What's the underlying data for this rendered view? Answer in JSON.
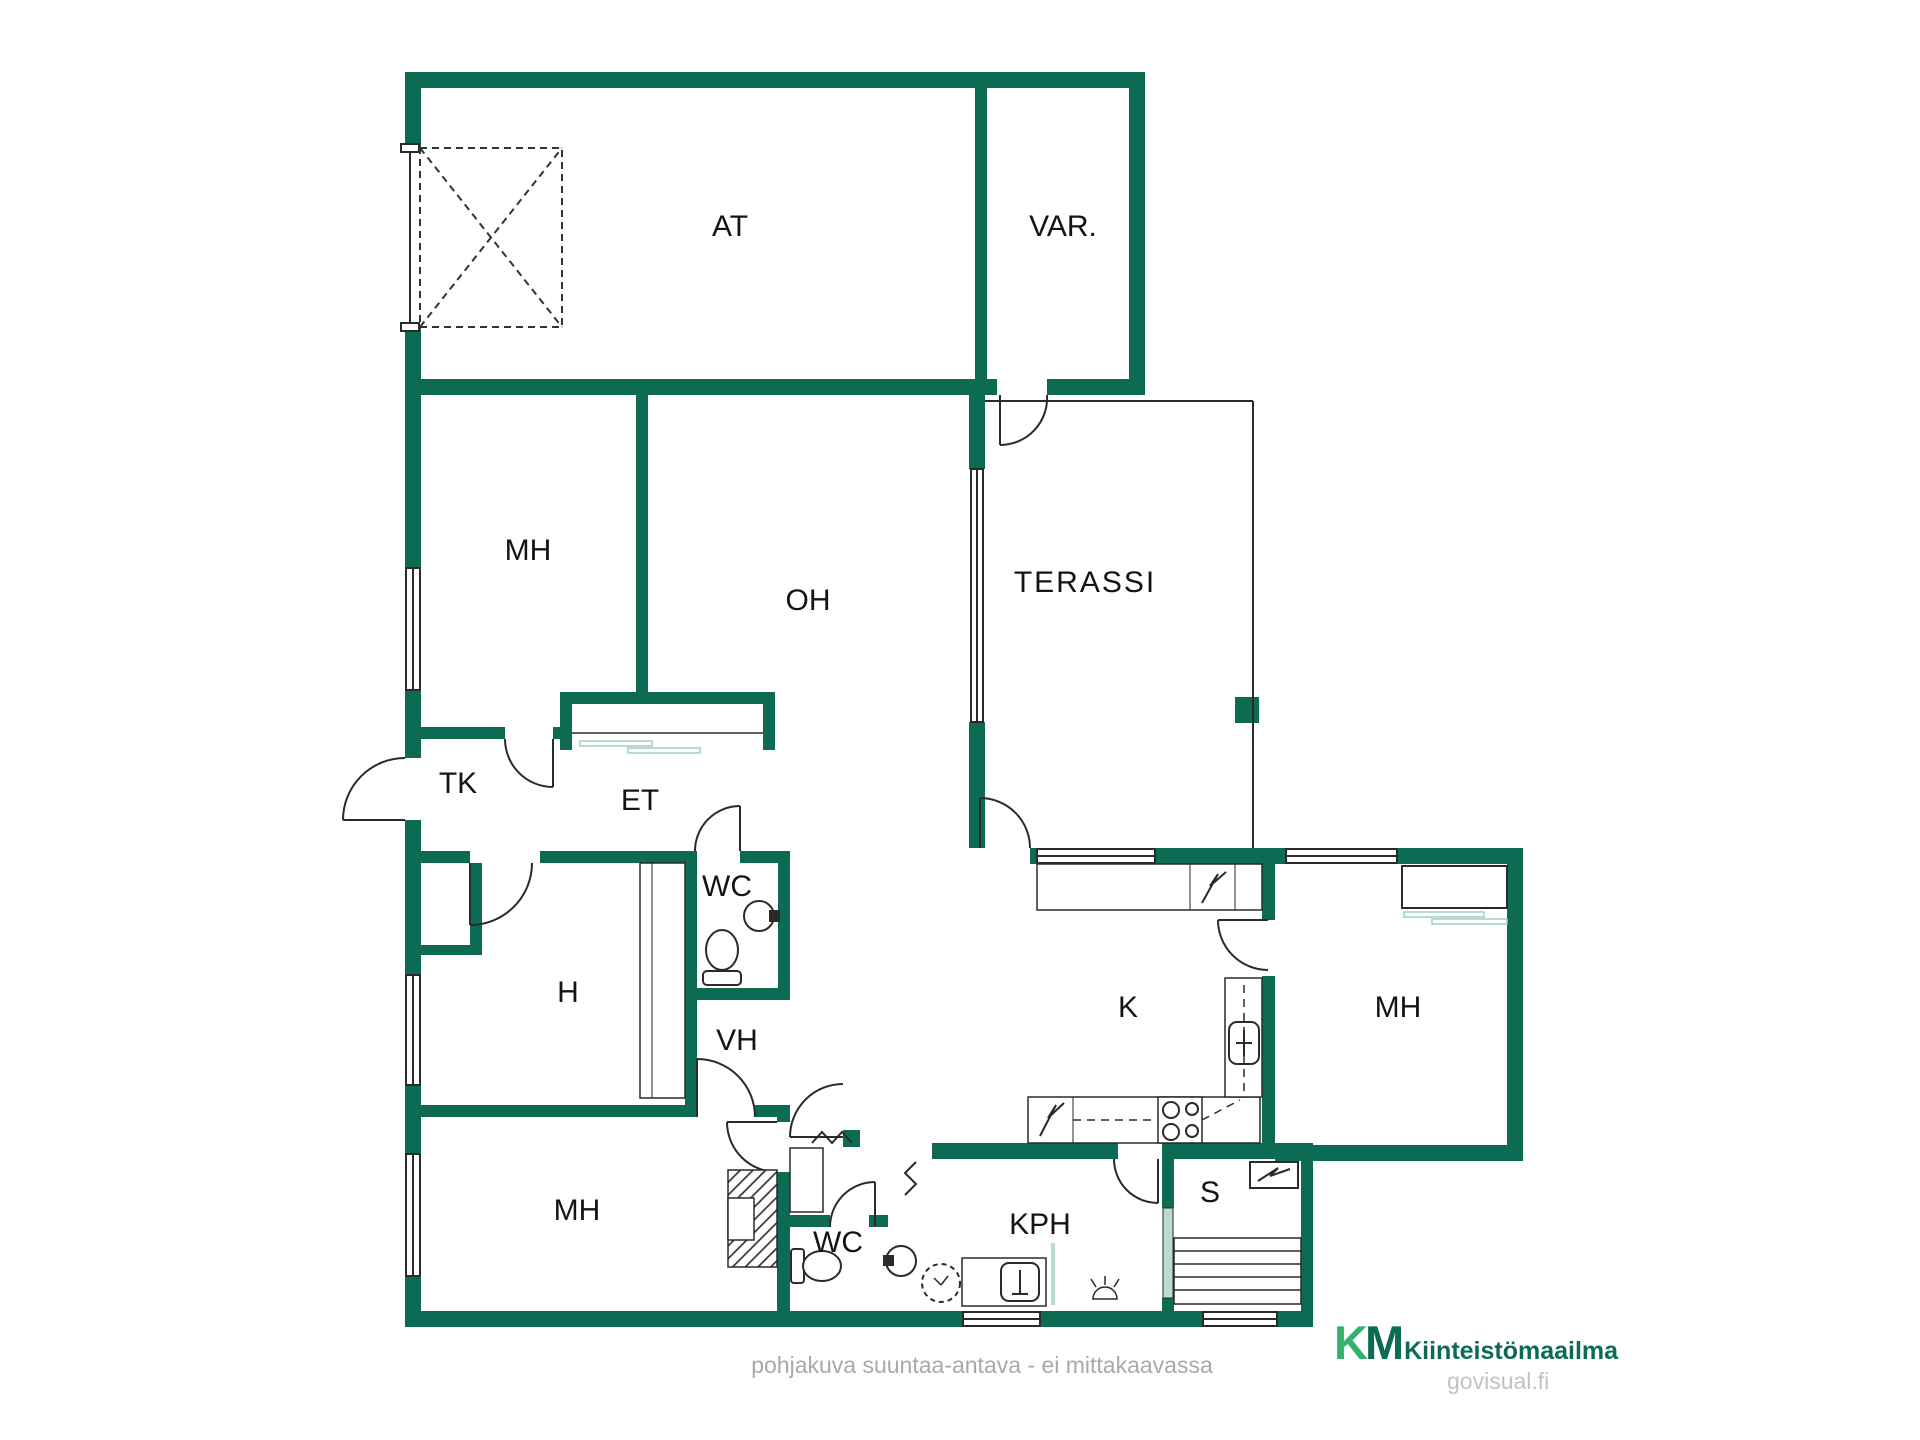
{
  "rooms": {
    "at": {
      "label": "AT"
    },
    "var": {
      "label": "VAR."
    },
    "mh1": {
      "label": "MH"
    },
    "oh": {
      "label": "OH"
    },
    "terassi": {
      "label": "TERASSI"
    },
    "tk": {
      "label": "TK"
    },
    "et": {
      "label": "ET"
    },
    "wc1": {
      "label": "WC"
    },
    "h": {
      "label": "H"
    },
    "vh": {
      "label": "VH"
    },
    "k": {
      "label": "K"
    },
    "mh2": {
      "label": "MH"
    },
    "mh3": {
      "label": "MH"
    },
    "wc2": {
      "label": "WC"
    },
    "kph": {
      "label": "KPH"
    },
    "s": {
      "label": "S"
    }
  },
  "footer": {
    "disclaimer": "pohjakuva suuntaa-antava - ei mittakaavassa"
  },
  "branding": {
    "logo_k": "K",
    "logo_m": "M",
    "company": "Kiinteistömaailma",
    "watermark": "govisual.fi"
  },
  "colors": {
    "wall": "#0d6b54",
    "line": "#2a2a2a",
    "glass": "#b9dcd2",
    "logo_light": "#35b06e",
    "logo_dark": "#0d6b54",
    "muted_text": "#a9a9a9"
  },
  "icons": {
    "toilet": "toilet-icon",
    "sink": "sink-icon",
    "washing_machine": "washing-machine-icon",
    "stove": "stove-icon",
    "electric_appliance": "lightning-bolt-icon",
    "sauna_heater": "sauna-heater-icon",
    "floor_drain": "floor-drain-icon"
  }
}
